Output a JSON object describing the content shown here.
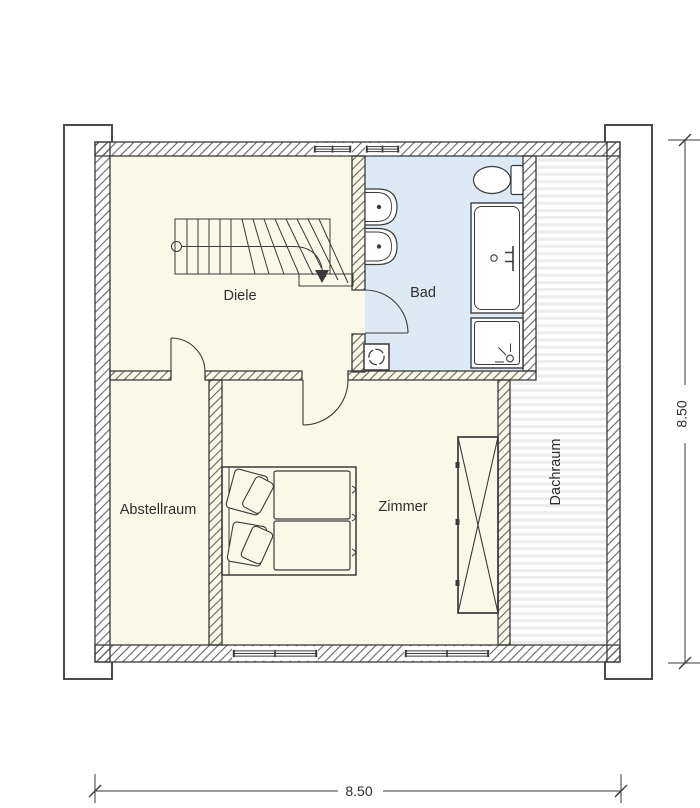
{
  "floorplan": {
    "rooms": {
      "diele": "Diele",
      "bad": "Bad",
      "abstellraum": "Abstellraum",
      "zimmer": "Zimmer",
      "dachraum": "Dachraum"
    },
    "dimensions": {
      "width": "8.50",
      "height": "8.50"
    },
    "fixtures": [
      "staircase",
      "walkline-arrow",
      "double-bed",
      "pillows",
      "wardrobe",
      "washbasin-1",
      "washbasin-2",
      "bathtub",
      "shower",
      "toilet",
      "washing-machine"
    ],
    "colors": {
      "room_fill": "#FAF9E7",
      "bath_fill": "#DEE9F6",
      "wall_line": "#3a3a3a",
      "stripe": "#ededed"
    }
  }
}
